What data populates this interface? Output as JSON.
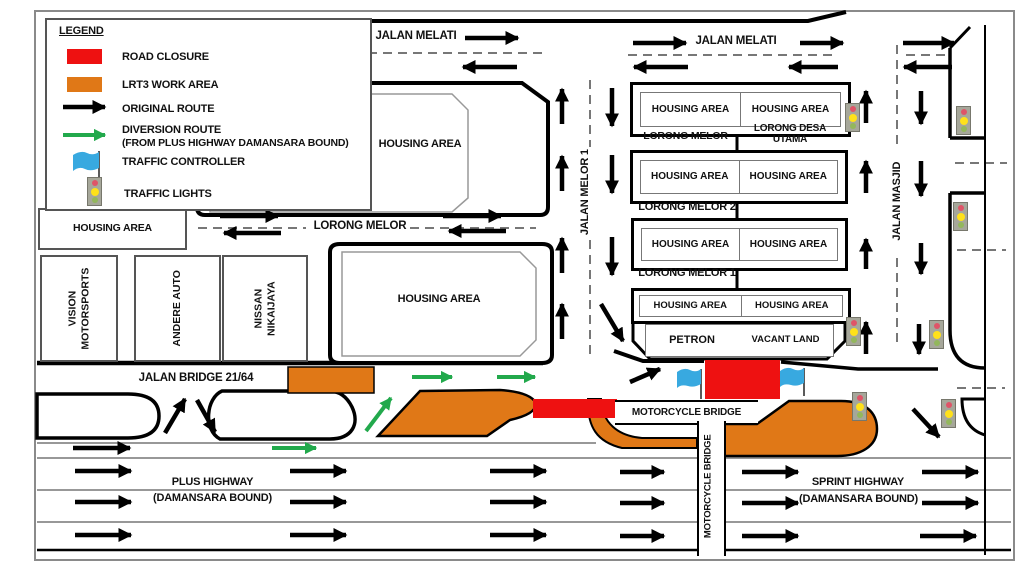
{
  "legend": {
    "title": "LEGEND",
    "road_closure": "ROAD CLOSURE",
    "lrt3_work_area": "LRT3 WORK AREA",
    "original_route": "ORIGINAL ROUTE",
    "diversion_route": "DIVERSION ROUTE",
    "diversion_route_note": "(FROM PLUS HIGHWAY DAMANSARA BOUND)",
    "traffic_controller": "TRAFFIC CONTROLLER",
    "traffic_lights": "TRAFFIC LIGHTS"
  },
  "roads": {
    "jalan_melati_w": "JALAN MELATI",
    "jalan_melati_e": "JALAN MELATI",
    "jalan_melor_1": "JALAN MELOR 1",
    "lorong_melor_road": "LORONG MELOR",
    "jalan_masjid": "JALAN MASJID",
    "jalan_bridge_21_64": "JALAN BRIDGE 21/64",
    "motorcycle_bridge_h": "MOTORCYCLE BRIDGE",
    "motorcycle_bridge_v": "MOTORCYCLE BRIDGE",
    "plus_highway": "PLUS HIGHWAY",
    "plus_highway_bound": "(DAMANSARA BOUND)",
    "sprint_highway": "SPRINT HIGHWAY",
    "sprint_highway_bound": "(DAMANSARA BOUND)",
    "lorong_melor_label": "LORONG MELOR",
    "lorong_desa_utama": "LORONG DESA UTAMA",
    "lorong_melor_2": "LORONG MELOR 2",
    "lorong_melor_1_label": "LORONG MELOR 1"
  },
  "areas": {
    "housing_nw": "HOUSING AREA",
    "housing_west": "HOUSING AREA",
    "housing_center": "HOUSING AREA",
    "vision_motorsports": "VISION MOTORSPORTS",
    "andere_auto": "ANDERE AUTO",
    "nissan_nikaijaya": "NISSAN NIKAIJAYA",
    "petron": "PETRON",
    "vacant_land": "VACANT LAND",
    "row1_left": "HOUSING AREA",
    "row1_right": "HOUSING AREA",
    "row2_left": "HOUSING AREA",
    "row2_right": "HOUSING AREA",
    "row3_left": "HOUSING AREA",
    "row3_right": "HOUSING AREA",
    "row4_left": "HOUSING AREA",
    "row4_right": "HOUSING AREA"
  },
  "colors": {
    "road_closure": "#ee1111",
    "lrt3_work_area": "#e07817",
    "original_route": "#000000",
    "diversion_route": "#22a94c",
    "traffic_controller": "#38a9e0"
  }
}
